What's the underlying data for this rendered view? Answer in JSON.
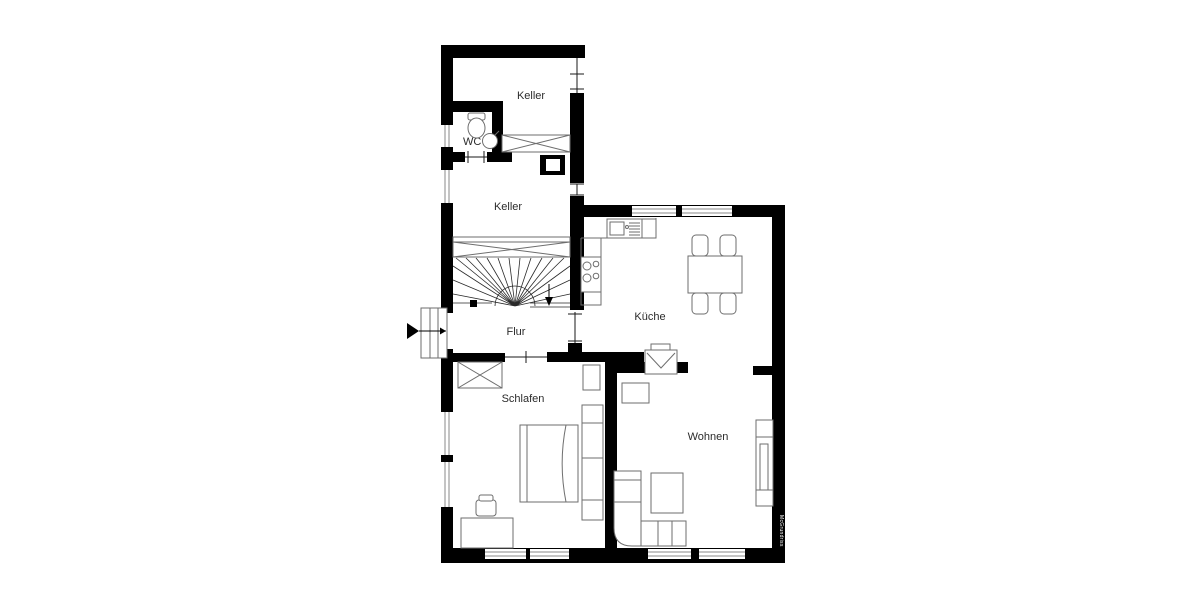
{
  "type": "floor-plan",
  "colors": {
    "wall": "#000000",
    "background": "#ffffff",
    "furniture": "#6e6e6e",
    "label": "#2b2b2b"
  },
  "rooms": {
    "keller_upper": {
      "label": "Keller"
    },
    "wc": {
      "label": "WC"
    },
    "keller_lower": {
      "label": "Keller"
    },
    "flur": {
      "label": "Flur"
    },
    "kueche": {
      "label": "Küche"
    },
    "schlafen": {
      "label": "Schlafen"
    },
    "wohnen": {
      "label": "Wohnen"
    }
  },
  "watermark": "McGrundriss",
  "symbols": [
    "entry-arrow-icon",
    "stairs",
    "toilet-icon",
    "sink-icon",
    "stove-icon",
    "kitchen-sink-icon",
    "dining-table",
    "chairs",
    "fireplace-oven-icon",
    "bed",
    "wardrobe",
    "closet",
    "desk",
    "desk-chair",
    "tv",
    "corner-sofa",
    "coffee-table",
    "shelf-unit",
    "windows",
    "doors"
  ]
}
